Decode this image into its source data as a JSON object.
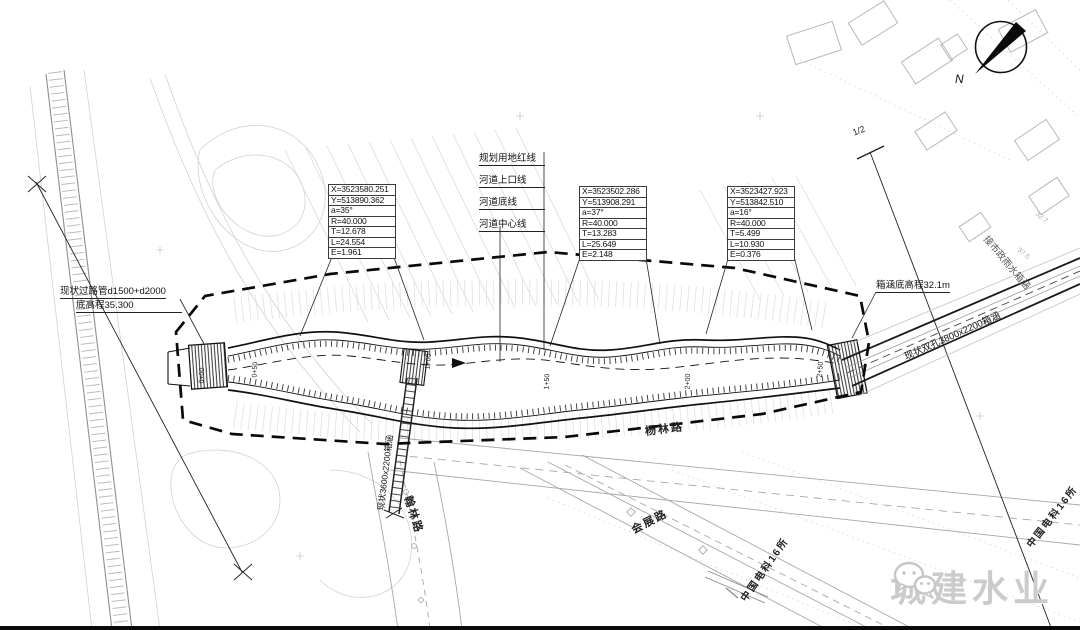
{
  "legend": [
    "规划用地红线",
    "河道上口线",
    "河道底线",
    "河道中心线"
  ],
  "curve_tables": [
    {
      "rows": [
        "X=3523580.251",
        "Y=513890.362",
        "a=35°",
        "R=40.000",
        "T=12.678",
        "L=24.554",
        "E=1.961"
      ]
    },
    {
      "rows": [
        "X=3523502.286",
        "Y=513908.291",
        "a=37°",
        "R=40.000",
        "T=13.283",
        "L=25.649",
        "E=2.148"
      ]
    },
    {
      "rows": [
        "X=3523427.923",
        "Y=513842.510",
        "a=16°",
        "R=40.000",
        "T=5.499",
        "L=10.930",
        "E=0.376"
      ]
    }
  ],
  "annotations": {
    "pipe_note_line1": "现状过路管d1500+d2000",
    "pipe_note_line2": "底高程35.300",
    "culvert_invert_note": "箱涵底高程32.1m",
    "double_culvert_note": "现状双孔3800x2200箱涵",
    "municipal_note": "接市政雨水箱涵",
    "crossing_culvert_note": "现状3600x2200箱涵",
    "section_marker": "1/2",
    "north_label": "N"
  },
  "roads": {
    "yanglin": "杨林路",
    "hanlin": "翰林路",
    "huizhan": "会展路",
    "cetc_a": "中国电科16所",
    "cetc_b": "中国电科16所"
  },
  "stations": [
    "0+00",
    "0+50",
    "1+00",
    "1+50",
    "2+00",
    "2+50"
  ],
  "spot_elevations": [
    "32.7",
    "37.5"
  ],
  "watermark": {
    "brand": "城建水业",
    "icon": "wechat-icon"
  }
}
